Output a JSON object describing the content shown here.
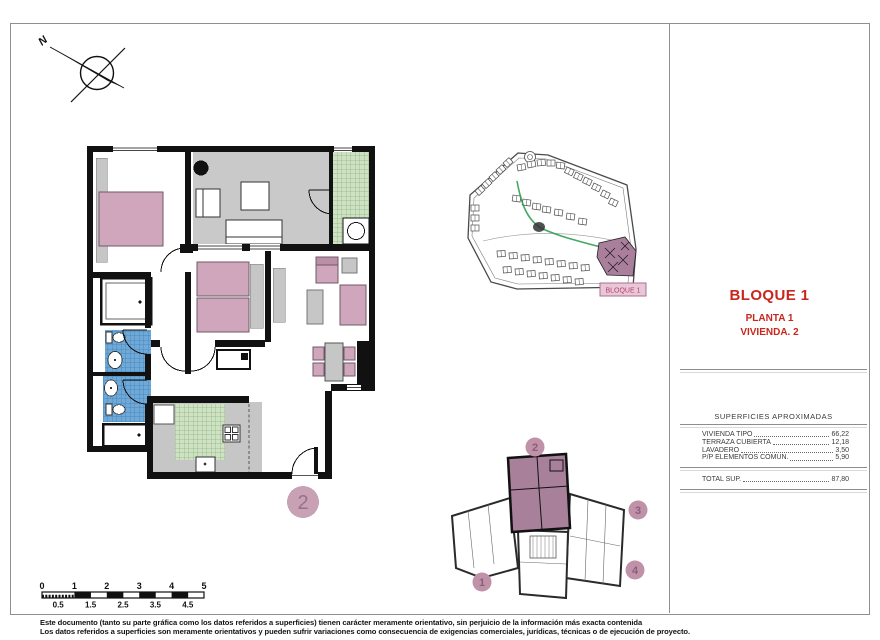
{
  "title_block": {
    "block": "BLOQUE 1",
    "floor": "PLANTA 1",
    "unit": "VIVIENDA. 2"
  },
  "areas_table": {
    "title": "SUPERFICIES APROXIMADAS",
    "rows": [
      {
        "label": "VIVIENDA TIPO",
        "value": "66,22"
      },
      {
        "label": "TERRAZA CUBIERTA",
        "value": "12,18"
      },
      {
        "label": "LAVADERO",
        "value": "3,50"
      },
      {
        "label": "P/P ELEMENTOS COMUN.",
        "value": "5,90"
      }
    ],
    "total_label": "TOTAL SUP.",
    "total_value": "87,80"
  },
  "site_plan": {
    "block_label": "BLOQUE 1"
  },
  "key_plan": {
    "unit_1": "1",
    "unit_2": "2",
    "unit_3": "3",
    "unit_4": "4",
    "highlighted_unit": "2"
  },
  "floor_plan": {
    "unit_badge": "2"
  },
  "north_arrow": {
    "label": "N"
  },
  "scale_bar": {
    "major": [
      "0",
      "1",
      "2",
      "3",
      "4",
      "5"
    ],
    "minor": [
      "0.5",
      "1.5",
      "2.5",
      "3.5",
      "4.5"
    ]
  },
  "document": {
    "disclaimer": [
      "Este documento (tanto su parte gráfica como los datos referidos a superficies) tienen carácter meramente orientativo, sin perjuicio de la información más exacta contenida",
      "Los datos referidos a superficies son meramente orientativos y pueden sufrir variaciones como consecuencia de exigencias comerciales, jurídicas, técnicas o de ejecución de proyecto."
    ]
  },
  "colors": {
    "accent_red": "#c9261d",
    "highlight_mauve": "#a8809a",
    "furniture_pink": "#cfa6bc",
    "tile_green": "#cfe2c4",
    "tile_blue": "#6fa9d8",
    "floor_gray": "#c9c9c9",
    "badge_pink": "#c8a1b5",
    "label_pink_bg": "#e9c6d8"
  }
}
